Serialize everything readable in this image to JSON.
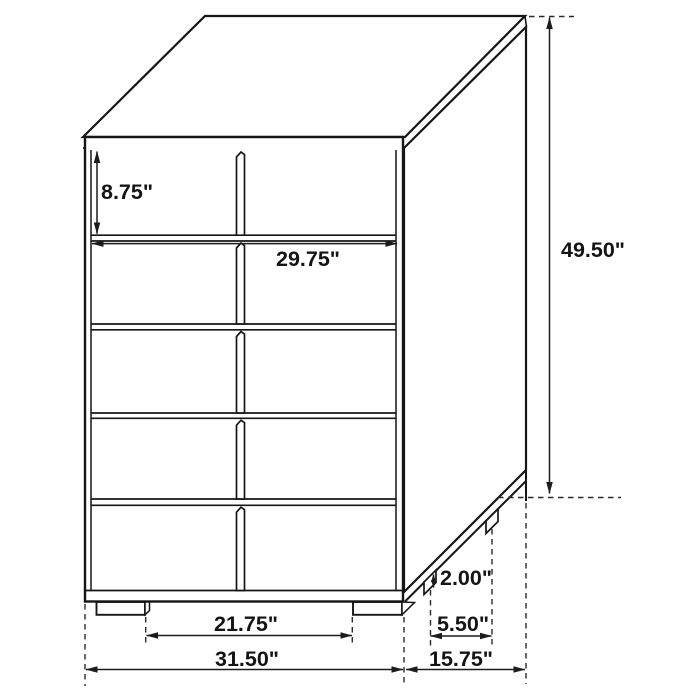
{
  "canvas": {
    "width": 700,
    "height": 700,
    "background": "#ffffff",
    "line_color": "#161616"
  },
  "diagram": {
    "subject": "5-drawer chest dimensional line drawing",
    "unit": "inches",
    "labels": {
      "drawer_height": "8.75\"",
      "drawer_width": "29.75\"",
      "overall_height": "49.50\"",
      "base_height": "2.00\"",
      "side_leg_spacing": "5.50\"",
      "front_leg_spacing": "21.75\"",
      "overall_width": "31.50\"",
      "overall_depth": "15.75\""
    }
  }
}
